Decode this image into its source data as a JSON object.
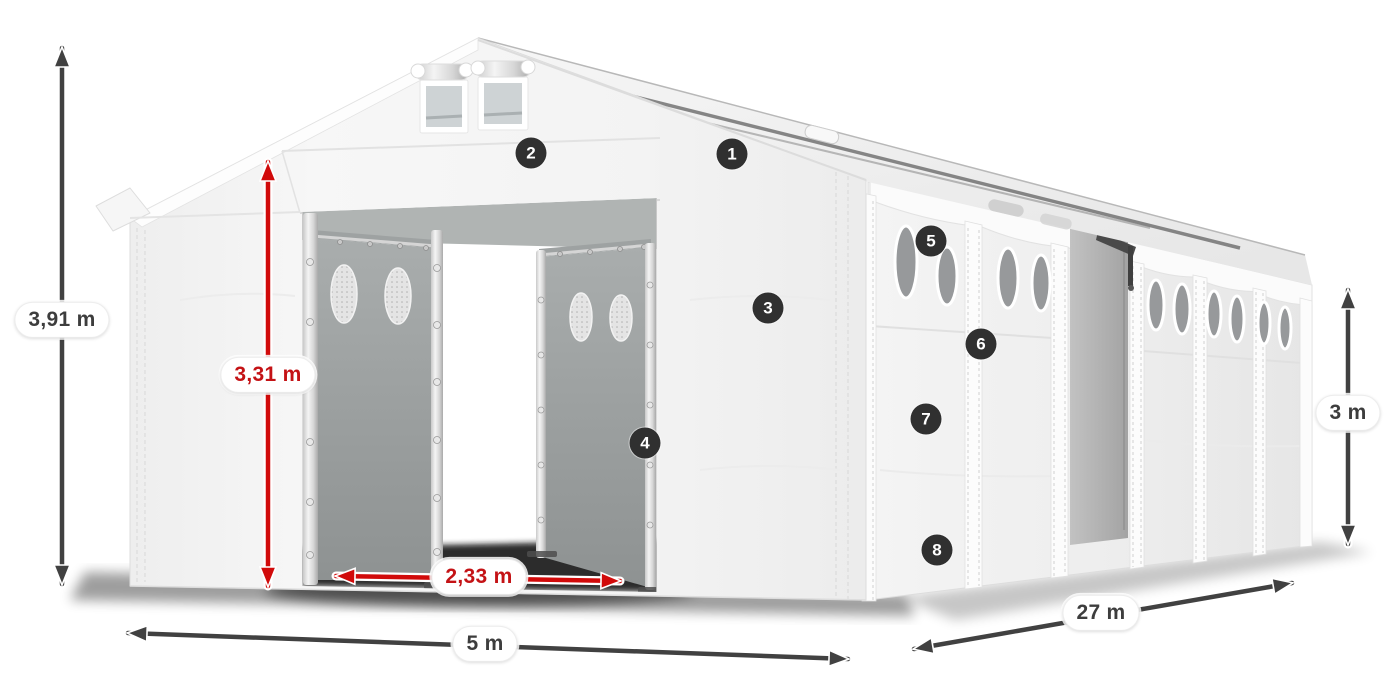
{
  "dimensions": {
    "height_total": "3,91 m",
    "door_height": "3,31 m",
    "door_width": "2,33 m",
    "width": "5 m",
    "length": "27 m",
    "wall_height": "3 m"
  },
  "badges": [
    "1",
    "2",
    "3",
    "4",
    "5",
    "6",
    "7",
    "8"
  ],
  "colors": {
    "accent_red": "#c41215",
    "arrow_dark": "#414141",
    "badge_bg": "#303030",
    "label_text": "#3d3d3d",
    "tent_white": "#f4f4f4",
    "panel_gray": "#9da1a1",
    "window_gray": "#97999b"
  }
}
